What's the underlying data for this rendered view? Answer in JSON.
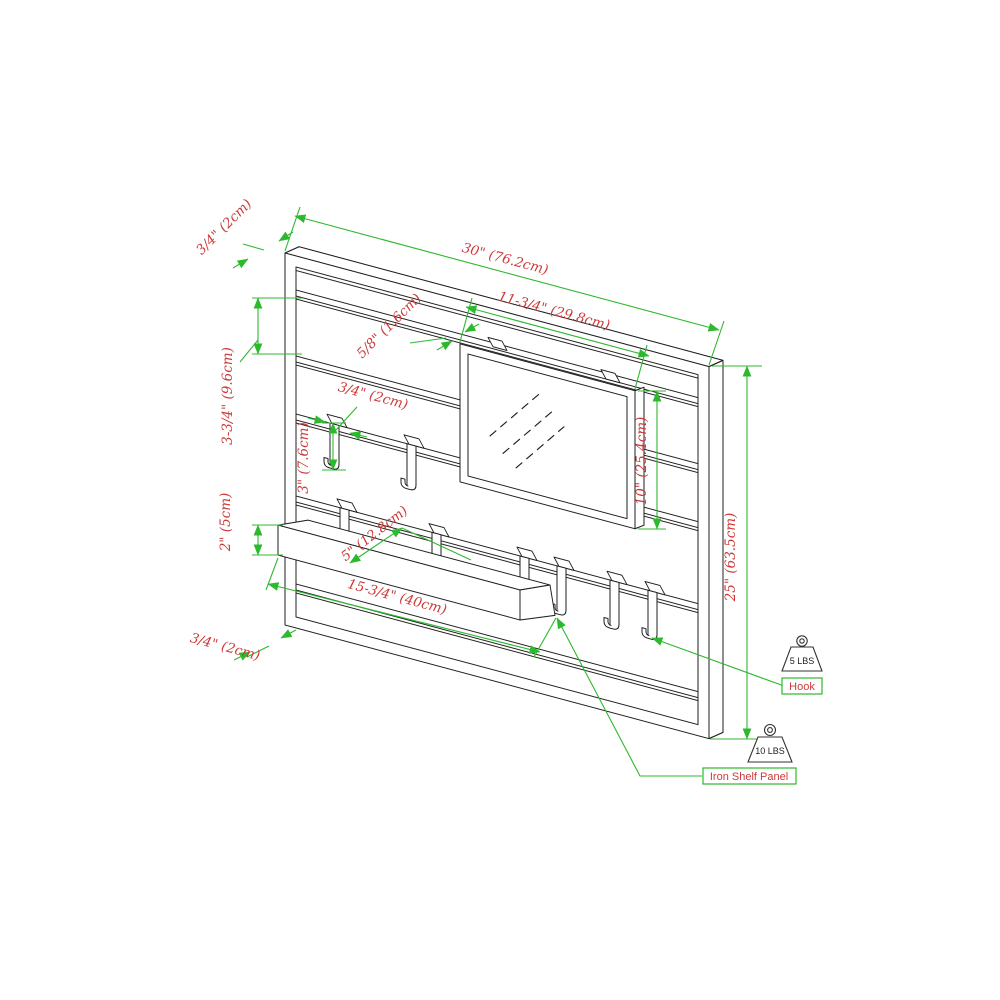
{
  "diagram": {
    "type": "product-dimension-drawing",
    "subject": "Wall-mounted iron shelf panel with mirror and hooks"
  },
  "colors": {
    "dimension_green": "#2db92d",
    "annotation_red": "#cc3a3a",
    "line_ink": "#1f1f1f",
    "background": "#ffffff"
  },
  "dims": {
    "frame_top": "3/4\" (2cm)",
    "overall_width": "30\" (76.2cm)",
    "mirror_width": "11-3/4\" (29.8cm)",
    "rail_thickness": "5/8\" (1.6cm)",
    "rail_gap": "3-3/4\" (9.6cm)",
    "hook_width": "3/4\" (2cm)",
    "hook_height": "3\" (7.6cm)",
    "shelf_height": "2\" (5cm)",
    "shelf_depth": "5\" (12.8cm)",
    "shelf_width": "15-3/4\" (40cm)",
    "frame_bottom": "3/4\" (2cm)",
    "mirror_height": "10\" (25.4cm)",
    "overall_height": "25\" (63.5cm)"
  },
  "labels": {
    "hook": "Hook",
    "shelf": "Iron Shelf Panel"
  },
  "weights": {
    "hook_capacity": "5 LBS",
    "shelf_capacity": "10 LBS"
  }
}
